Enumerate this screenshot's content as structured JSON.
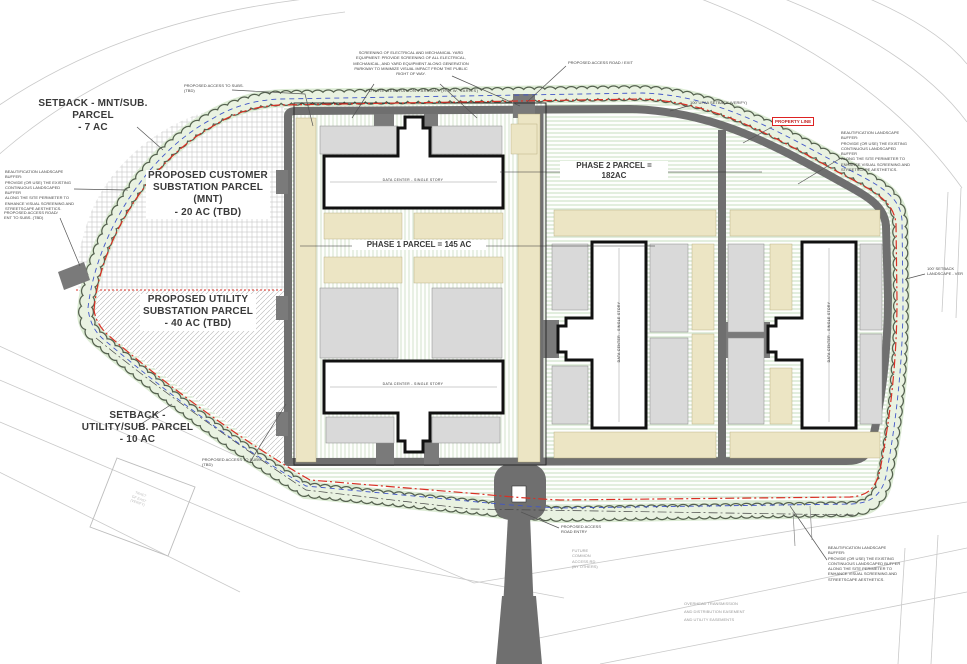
{
  "plan": {
    "parcel_labels": {
      "setback_mnt": [
        "SETBACK - MNT/SUB.",
        "PARCEL",
        "- 7 AC"
      ],
      "customer_sub": [
        "PROPOSED CUSTOMER",
        "SUBSTATION PARCEL",
        "(MNT)",
        "- 20 AC (TBD)"
      ],
      "utility_sub": [
        "PROPOSED UTILITY",
        "SUBSTATION PARCEL",
        "- 40 AC (TBD)"
      ],
      "setback_utility": [
        "SETBACK -",
        "UTILITY/SUB. PARCEL",
        "- 10 AC"
      ],
      "phase1": "PHASE 1  PARCEL = 145 AC",
      "phase2": [
        "PHASE 2  PARCEL =",
        "182AC"
      ]
    },
    "building_label": "DATA CENTER - SINGLE STORY",
    "notes": {
      "screening": [
        "SCREENING OF ELECTRICAL AND MECHANICAL YARD",
        "EQUIPMENT: PROVIDE SCREENING OF ALL ELECTRICAL,",
        "MECHANICAL, AND YARD EQUIPMENT ALONG GENERATION",
        "PARKWAY TO MINIMIZE VISUAL IMPACT FROM THE PUBLIC",
        "RIGHT OF WAY."
      ],
      "parkway": "FUTURE GENERATION PARKWAY (R.O.W. VARIES)",
      "access_road_exit": "PROPOSED ACCESS ROAD / EXIT",
      "access_to_subs": [
        "PROPOSED ACCESS TO SUBS.",
        "(TBD)"
      ],
      "upaa_setback": "100' UPAA SETBACK (VERIFY)",
      "property_line": "PROPERTY LINE",
      "beautification": [
        "BEAUTIFICATION LANDSCAPE BUFFER:",
        "PROVIDE (OR USE) THE EXISTING",
        "CONTINUOUS LANDSCAPED BUFFER",
        "ALONG THE SITE PERIMETER TO",
        "ENHANCE VISUAL SCREENING AND",
        "STREETSCAPE AESTHETICS."
      ],
      "setback_landscape": [
        "100' SETBACK",
        "LANDSCAPE - VER"
      ],
      "access_road_ent": [
        "PROPOSED ACCESS ROAD/",
        "ENT TO SUBS. (TBD)"
      ],
      "access_road_entry": [
        "PROPOSED ACCESS",
        "ROAD ENTRY"
      ],
      "future_common": [
        "FUTURE",
        "COMMON",
        "ACCESS RD",
        "(BY OTHERS)"
      ],
      "easement": [
        "OVERHEAD TRANSMISSION",
        "AND DISTRIBUTION EASEMENT",
        "AND UTILITY EASEMENTS"
      ],
      "tract": [
        "TRACT",
        "GF EAST",
        "(VERIFY)"
      ]
    },
    "colors": {
      "road": "#6f6f6f",
      "yard_gray": "#d9d9d9",
      "equipment_strip": "#ece5c4",
      "tree_fill": "#e9f2e1",
      "property_line_red": "#d93025",
      "buffer_blue": "#4156c8",
      "building_outline": "#111111"
    }
  }
}
